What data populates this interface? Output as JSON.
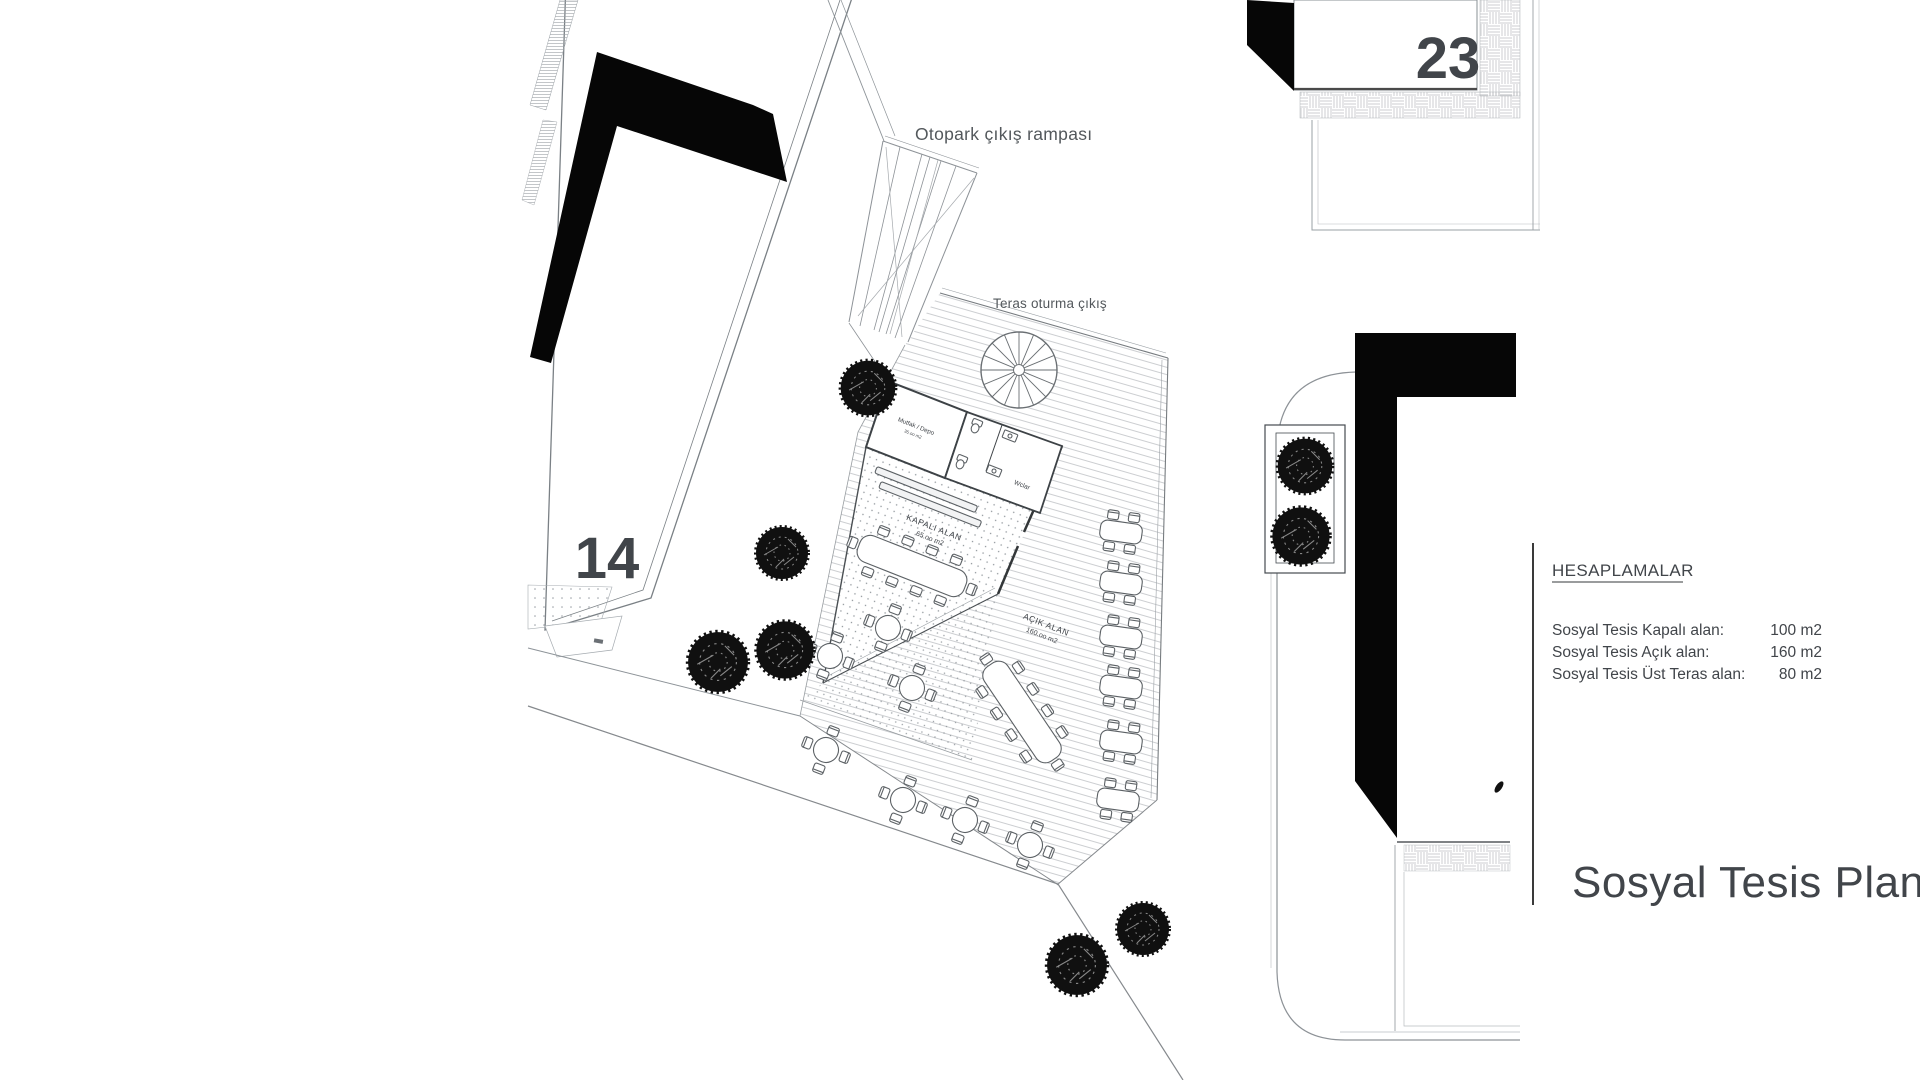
{
  "plan": {
    "title": "Sosyal Tesis Planı",
    "labels": {
      "otopark_ramp": "Otopark çıkış rampası",
      "teras_exit": "Teras oturma çıkış",
      "building_left_no": "14",
      "building_topright_no": "23",
      "kitchen_room": "Mutfak / Depo",
      "kitchen_area": "35.oo m2",
      "wc_room": "Wclar",
      "closed_area_title": "KAPALI ALAN",
      "closed_area_value": "65.oo m2",
      "open_area_title": "AÇIK ALAN",
      "open_area_value": "160.oo m2"
    },
    "calculations": {
      "heading": "HESAPLAMALAR",
      "rows": [
        {
          "label": "Sosyal Tesis Kapalı alan:",
          "value": "100 m2"
        },
        {
          "label": "Sosyal Tesis Açık alan:",
          "value": "160 m2"
        },
        {
          "label": "Sosyal Tesis Üst Teras alan:",
          "value": "80 m2"
        }
      ]
    },
    "colors": {
      "ink": "#060606",
      "line": "#5c6165",
      "hatch": "#c6c9cc",
      "text": "#41454a"
    }
  }
}
